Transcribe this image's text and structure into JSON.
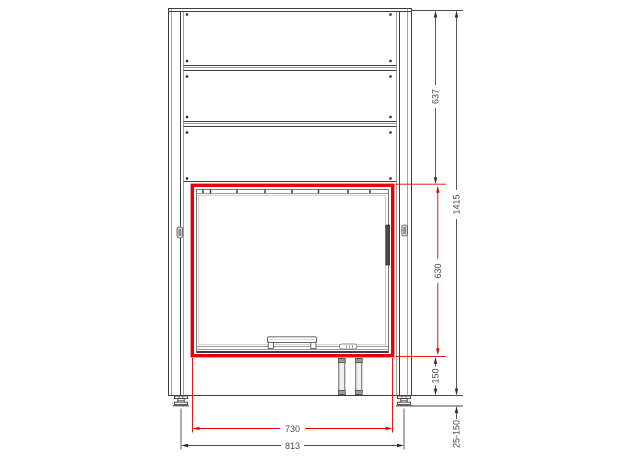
{
  "dimensions": {
    "upper_body_height": "637",
    "total_height": "1415",
    "opening_height": "630",
    "base_height": "150",
    "foot_adjust_range": "25-150",
    "opening_width": "730",
    "overall_width": "813"
  },
  "colors": {
    "highlight_red": "#e80000",
    "line_dark": "#3d3d3d",
    "dimension_text": "#4a4a4a",
    "background": "#ffffff"
  }
}
